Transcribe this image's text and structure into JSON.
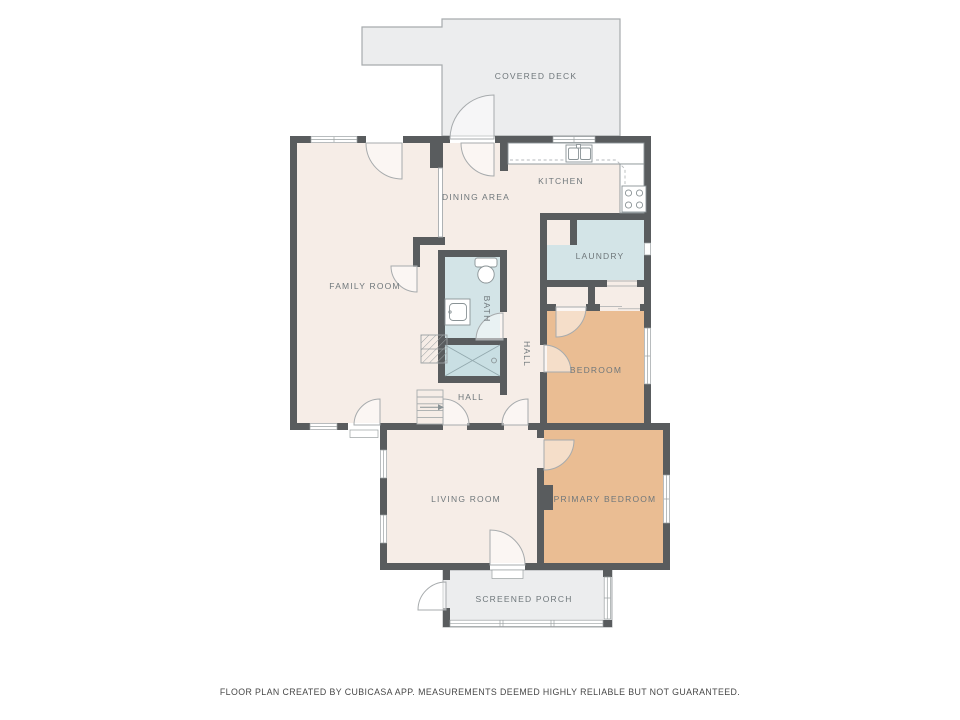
{
  "colors": {
    "wall": "#595c5e",
    "floor": "#f6ede7",
    "wet": "#d3e4e7",
    "shower": "#c9dfe3",
    "bedroom": "#eabd93",
    "deck": "#ecedee",
    "line": "#a7abad",
    "fixture": "#8a9396",
    "counterline": "#b6babc",
    "label": "#6f777b",
    "footer": "#474747"
  },
  "rooms": [
    {
      "name": "covered-deck",
      "label": "COVERED DECK"
    },
    {
      "name": "kitchen",
      "label": "KITCHEN"
    },
    {
      "name": "dining-area",
      "label": "DINING AREA"
    },
    {
      "name": "family-room",
      "label": "FAMILY ROOM"
    },
    {
      "name": "laundry",
      "label": "LAUNDRY"
    },
    {
      "name": "bath",
      "label": "BATH"
    },
    {
      "name": "hall-upper",
      "label": "HALL"
    },
    {
      "name": "hall-lower",
      "label": "HALL"
    },
    {
      "name": "bedroom",
      "label": "BEDROOM"
    },
    {
      "name": "living-room",
      "label": "LIVING ROOM"
    },
    {
      "name": "primary-bedroom",
      "label": "PRIMARY BEDROOM"
    },
    {
      "name": "screened-porch",
      "label": "SCREENED PORCH"
    }
  ],
  "fixtures": [
    "kitchen-sink",
    "stove-cooktop",
    "upper-cabinets-dashed",
    "toilet",
    "vanity-sink",
    "shower",
    "staircase-with-arrow",
    "chimney-hatch",
    "fireplace-bump",
    "door-swings",
    "windows"
  ],
  "footer": {
    "text": "FLOOR PLAN CREATED BY CUBICASA APP. MEASUREMENTS DEEMED HIGHLY RELIABLE BUT NOT GUARANTEED."
  }
}
